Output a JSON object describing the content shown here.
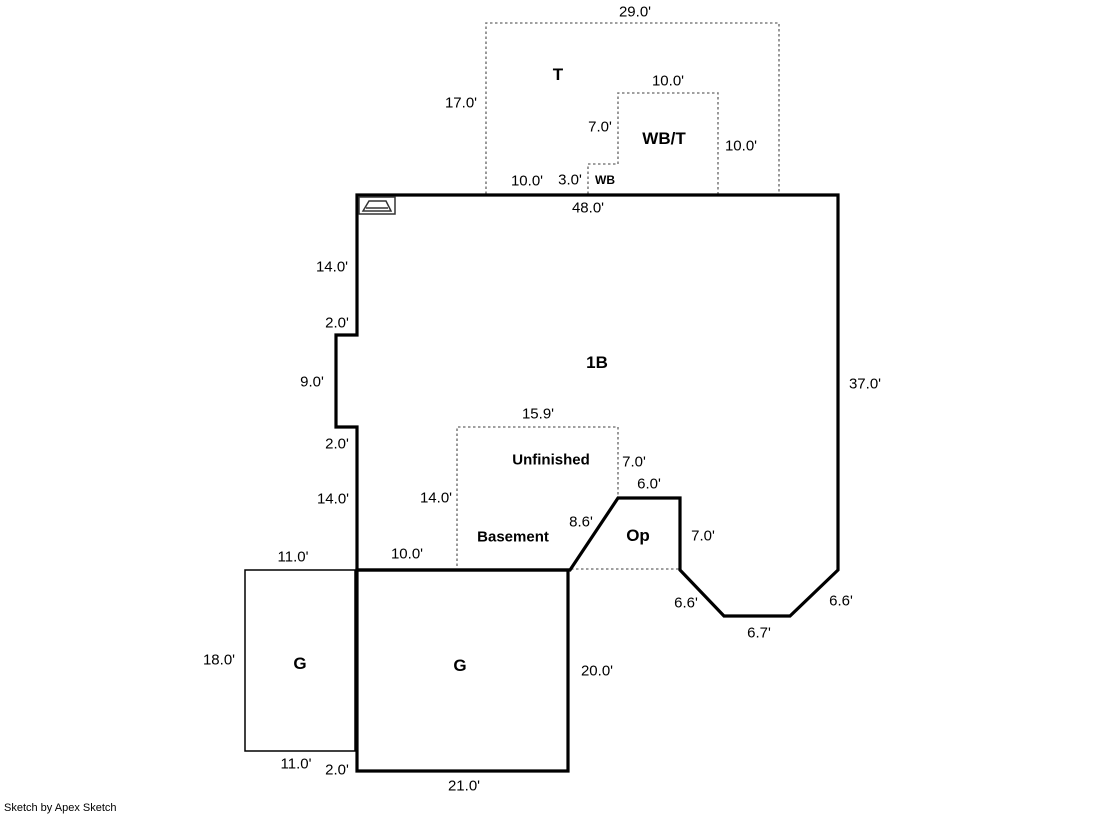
{
  "title": "Apex Sketch floor plan",
  "colors": {
    "background": "#ffffff",
    "wall": "#000000",
    "dashed": "#808080",
    "text": "#000000"
  },
  "footer": {
    "credit": "Sketch by Apex Sketch"
  },
  "areas": {
    "terrace": "T",
    "wood_balcony_terrace": "WB/T",
    "wood_balcony": "WB",
    "first_floor": "1B",
    "basement_line1": "Unfinished",
    "basement_line2": "Basement",
    "open_porch": "Op",
    "garage_left": "G",
    "garage_main": "G"
  },
  "labels": [
    {
      "name": "dim-t-width",
      "text": "29.0'",
      "x": 635,
      "y": 12,
      "style": "dim"
    },
    {
      "name": "area-terrace",
      "text": "T",
      "x": 558,
      "y": 75,
      "style": "area"
    },
    {
      "name": "dim-t-height",
      "text": "17.0'",
      "x": 461,
      "y": 103,
      "style": "dim"
    },
    {
      "name": "dim-wbt-width",
      "text": "10.0'",
      "x": 668,
      "y": 81,
      "style": "dim"
    },
    {
      "name": "dim-wbt-left",
      "text": "7.0'",
      "x": 600,
      "y": 127,
      "style": "dim"
    },
    {
      "name": "area-wbt",
      "text": "WB/T",
      "x": 664,
      "y": 139,
      "style": "area"
    },
    {
      "name": "dim-wbt-right",
      "text": "10.0'",
      "x": 741,
      "y": 146,
      "style": "dim"
    },
    {
      "name": "dim-t-bottom",
      "text": "10.0'",
      "x": 527,
      "y": 181,
      "style": "dim"
    },
    {
      "name": "dim-wb-width",
      "text": "3.0'",
      "x": 570,
      "y": 180,
      "style": "dim"
    },
    {
      "name": "area-wb",
      "text": "WB",
      "x": 605,
      "y": 180,
      "style": "wb"
    },
    {
      "name": "dim-top-wall",
      "text": "48.0'",
      "x": 588,
      "y": 208,
      "style": "dim"
    },
    {
      "name": "dim-left-upper",
      "text": "14.0'",
      "x": 332,
      "y": 267,
      "style": "dim"
    },
    {
      "name": "dim-jog-top",
      "text": "2.0'",
      "x": 337,
      "y": 323,
      "style": "dim"
    },
    {
      "name": "dim-jog-side",
      "text": "9.0'",
      "x": 312,
      "y": 382,
      "style": "dim"
    },
    {
      "name": "dim-jog-bottom",
      "text": "2.0'",
      "x": 337,
      "y": 444,
      "style": "dim"
    },
    {
      "name": "dim-left-lower",
      "text": "14.0'",
      "x": 333,
      "y": 499,
      "style": "dim"
    },
    {
      "name": "area-first-floor",
      "text": "1B",
      "x": 597,
      "y": 363,
      "style": "area"
    },
    {
      "name": "dim-right-wall",
      "text": "37.0'",
      "x": 865,
      "y": 384,
      "style": "dim"
    },
    {
      "name": "dim-basement-width",
      "text": "15.9'",
      "x": 538,
      "y": 414,
      "style": "dim"
    },
    {
      "name": "area-basement-line1",
      "text": "Unfinished",
      "x": 551,
      "y": 460,
      "style": "area-sm"
    },
    {
      "name": "dim-basement-right",
      "text": "7.0'",
      "x": 634,
      "y": 462,
      "style": "dim"
    },
    {
      "name": "dim-op-top",
      "text": "6.0'",
      "x": 649,
      "y": 484,
      "style": "dim"
    },
    {
      "name": "dim-basement-left",
      "text": "14.0'",
      "x": 436,
      "y": 498,
      "style": "dim"
    },
    {
      "name": "area-basement-line2",
      "text": "Basement",
      "x": 513,
      "y": 537,
      "style": "area-sm"
    },
    {
      "name": "dim-op-diagonal",
      "text": "8.6'",
      "x": 581,
      "y": 522,
      "style": "dim"
    },
    {
      "name": "area-open-porch",
      "text": "Op",
      "x": 638,
      "y": 536,
      "style": "area"
    },
    {
      "name": "dim-op-right",
      "text": "7.0'",
      "x": 703,
      "y": 536,
      "style": "dim"
    },
    {
      "name": "dim-bay-left",
      "text": "6.6'",
      "x": 686,
      "y": 603,
      "style": "dim"
    },
    {
      "name": "dim-bay-bottom",
      "text": "6.7'",
      "x": 759,
      "y": 633,
      "style": "dim"
    },
    {
      "name": "dim-bay-right",
      "text": "6.6'",
      "x": 841,
      "y": 601,
      "style": "dim"
    },
    {
      "name": "dim-garage-left-top",
      "text": "11.0'",
      "x": 293,
      "y": 557,
      "style": "dim"
    },
    {
      "name": "dim-bottom-wall-seg",
      "text": "10.0'",
      "x": 407,
      "y": 554,
      "style": "dim"
    },
    {
      "name": "dim-garage-left-side",
      "text": "18.0'",
      "x": 219,
      "y": 660,
      "style": "dim"
    },
    {
      "name": "area-garage-left",
      "text": "G",
      "x": 300,
      "y": 664,
      "style": "area"
    },
    {
      "name": "area-garage-main",
      "text": "G",
      "x": 460,
      "y": 666,
      "style": "area"
    },
    {
      "name": "dim-garage-main-right",
      "text": "20.0'",
      "x": 597,
      "y": 671,
      "style": "dim"
    },
    {
      "name": "dim-garage-left-bottom",
      "text": "11.0'",
      "x": 296,
      "y": 764,
      "style": "dim"
    },
    {
      "name": "dim-garage-main-offset",
      "text": "2.0'",
      "x": 337,
      "y": 770,
      "style": "dim"
    },
    {
      "name": "dim-garage-main-bottom",
      "text": "21.0'",
      "x": 464,
      "y": 786,
      "style": "dim"
    }
  ]
}
